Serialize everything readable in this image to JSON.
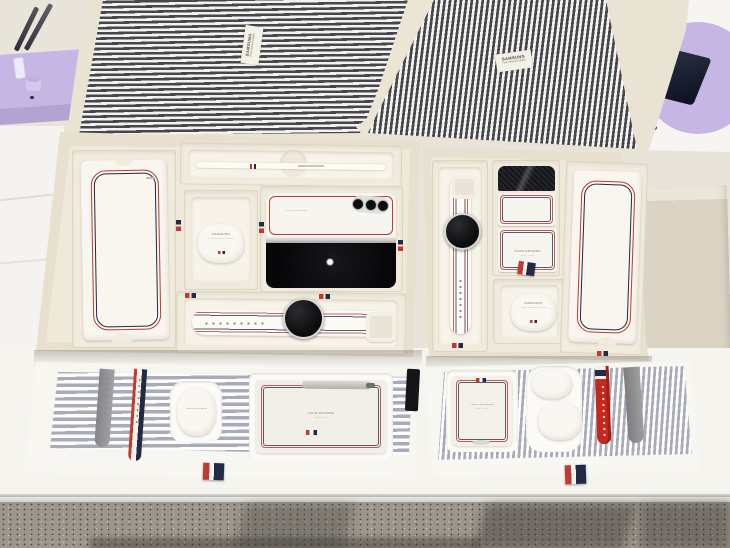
{
  "scene": {
    "setting": "Samsung x Thom Browne Edition retail display: two open pinstripe-lid gift boxes with pulled-out accessory drawers on a white table"
  },
  "colors": {
    "wall": "#e9e4da",
    "table": "#f5f4ef",
    "floor": "#9c968c",
    "stripe_dark": "#46464e",
    "stripe_light": "#f4f2ec",
    "drawer_stripe": "#a9abb8",
    "cream": "#e9e3d3",
    "tray_wall": "#e7e0ce",
    "tray_floor": "#efe9da",
    "box_white": "#f9f6ef",
    "red": "#bf3a33",
    "navy": "#222a44",
    "screen_black": "#0b0c10",
    "lavender": "#c6b6e4",
    "beige_panel": "#dbd4c4"
  },
  "lids": {
    "left_label": {
      "brand": "SAMSUNG",
      "line": "Thom Browne Edition"
    },
    "right_label": {
      "brand": "SAMSUNG",
      "line": "Thom Browne Edition"
    }
  },
  "left_box": {
    "earbuds": {
      "brand": "SAMSUNG",
      "sub": "Thom Browne Edition"
    },
    "fold_back": {
      "brand": "THOM BROWNE"
    }
  },
  "right_box": {
    "flip_panel": {
      "brand": "THOM BROWNE",
      "sub": "NEW YORK"
    },
    "earbuds": {
      "brand": "SAMSUNG",
      "sub": "Thom Browne Edition"
    }
  },
  "drawers": {
    "left": {
      "earbuds_case": {
        "brand": "THOM BROWNE",
        "sub": "NEW YORK"
      },
      "phone_case": {
        "brand": "THOM BROWNE",
        "sub": "NEW YORK"
      }
    },
    "right": {
      "flip_case": {
        "brand": "THOM BROWNE",
        "sub": "NEW YORK"
      }
    }
  }
}
